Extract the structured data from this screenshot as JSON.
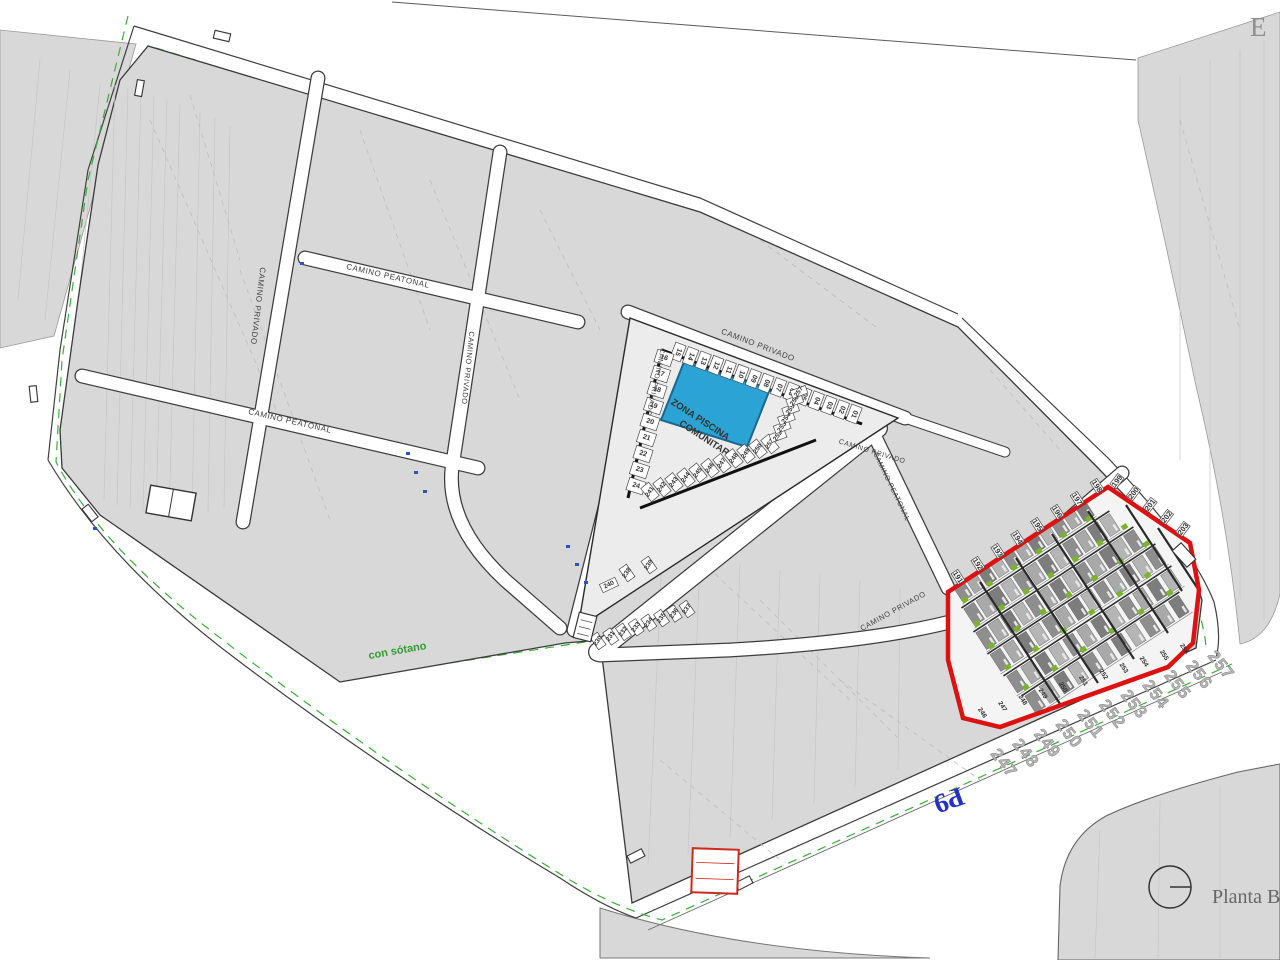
{
  "top_right_letter": "E",
  "planta_label": "Planta B",
  "p9_label": "P9",
  "con_sotano_label": "con sótano",
  "pool": {
    "line1": "ZONA PISCINA",
    "line2": "COMUNITARIA"
  },
  "colors": {
    "parcel": "#d8d8d8",
    "road_green": "#3cac3c",
    "red_border": "#dd1111",
    "pool_fill": "#2ba3d4",
    "pool_stroke": "#19688f",
    "blue_text": "#2430c8",
    "green_text": "#2f9e2f",
    "bush": "#79b42c"
  },
  "road_labels": [
    {
      "text": "CAMINO PEATONAL",
      "x": 388,
      "y": 276,
      "rot": 13,
      "size": 8
    },
    {
      "text": "CAMINO PRIVADO",
      "x": 258,
      "y": 306,
      "rot": 97,
      "size": 8
    },
    {
      "text": "CAMINO PEATONAL",
      "x": 290,
      "y": 421,
      "rot": 13,
      "size": 8
    },
    {
      "text": "CAMINO PRIVADO",
      "x": 468,
      "y": 368,
      "rot": 96,
      "size": 7.5
    },
    {
      "text": "CAMINO PRIVADO",
      "x": 758,
      "y": 345,
      "rot": 21,
      "size": 8
    },
    {
      "text": "CAMINO PRIVADO",
      "x": 655,
      "y": 382,
      "rot": 102,
      "size": 7
    },
    {
      "text": "CAMINO PEATONAL",
      "x": 891,
      "y": 487,
      "rot": 64,
      "size": 7
    },
    {
      "text": "CAMINO PRIVADO",
      "x": 872,
      "y": 452,
      "rot": 17,
      "size": 7
    },
    {
      "text": "CAMINO PRIVADO",
      "x": 893,
      "y": 611,
      "rot": -29,
      "size": 7.5
    }
  ],
  "number_strips": [
    {
      "id": "pool-top",
      "values": [
        "15",
        "14",
        "13",
        "12",
        "11",
        "10",
        "09",
        "08",
        "07",
        "06",
        "05",
        "04",
        "03",
        "02",
        "01"
      ],
      "x1": 678,
      "y1": 352,
      "x2": 854,
      "y2": 414,
      "rot": 111,
      "size": 7,
      "cell": {
        "w": 11,
        "h": 17,
        "rot": 21
      }
    },
    {
      "id": "pool-left",
      "values": [
        "16",
        "17",
        "18",
        "19",
        "20",
        "21",
        "22",
        "23",
        "24"
      ],
      "x1": 664,
      "y1": 358,
      "x2": 636,
      "y2": 486,
      "rot": 18,
      "size": 7,
      "cell": {
        "w": 17,
        "h": 13,
        "rot": 18
      }
    },
    {
      "id": "row-241",
      "values": [
        "241",
        "242",
        "243",
        "244",
        "245",
        "246",
        "247",
        "248",
        "249",
        "250",
        "251"
      ],
      "x1": 650,
      "y1": 492,
      "x2": 770,
      "y2": 444,
      "rot": -55,
      "size": 6.5,
      "cell": {
        "w": 10,
        "h": 17,
        "rot": -39
      }
    },
    {
      "id": "row-252",
      "values": [
        "252",
        "253",
        "254",
        "255",
        "256",
        "257"
      ],
      "x1": 778,
      "y1": 436,
      "x2": 799,
      "y2": 392,
      "rot": -55,
      "size": 6.5,
      "cell": {
        "w": 16,
        "h": 8,
        "rot": -20
      }
    },
    {
      "id": "tip-230",
      "values": [
        "230",
        "231",
        "232",
        "233",
        "234",
        "235",
        "236",
        "237"
      ],
      "x1": 598,
      "y1": 641,
      "x2": 687,
      "y2": 609,
      "rot": -55,
      "size": 6.5,
      "cell": {
        "w": 9,
        "h": 15,
        "rot": -35
      }
    },
    {
      "id": "tip-238",
      "values": [
        "238",
        "239"
      ],
      "x1": 627,
      "y1": 573,
      "x2": 649,
      "y2": 565,
      "rot": -55,
      "size": 6.5,
      "cell": {
        "w": 9,
        "h": 15,
        "rot": -35
      }
    },
    {
      "id": "tip-240",
      "values": [
        "240"
      ],
      "x1": 609,
      "y1": 585,
      "x2": 609,
      "y2": 585,
      "rot": -25,
      "size": 6.5,
      "cell": {
        "w": 17,
        "h": 9,
        "rot": -25
      }
    },
    {
      "id": "red-top",
      "values": [
        "191",
        "192",
        "193",
        "194",
        "195",
        "196",
        "197",
        "198"
      ],
      "x1": 958,
      "y1": 577,
      "x2": 1097,
      "y2": 486,
      "rot": 57,
      "size": 7.5,
      "cell": {
        "w": 8,
        "h": 13,
        "rot": -33
      }
    },
    {
      "id": "red-corner",
      "values": [
        "199",
        "200",
        "201",
        "202",
        "203"
      ],
      "x1": 1117,
      "y1": 481,
      "x2": 1183,
      "y2": 529,
      "rot": -53,
      "size": 7.5,
      "cell": {
        "w": 8,
        "h": 13,
        "rot": 37
      }
    },
    {
      "id": "red-bottom-small",
      "values": [
        "246",
        "247",
        "248",
        "249",
        "250",
        "251",
        "252",
        "253",
        "254",
        "255",
        "256"
      ],
      "x1": 982,
      "y1": 713,
      "x2": 1184,
      "y2": 649,
      "rot": 57,
      "size": 6.5
    },
    {
      "id": "street-numbers",
      "values": [
        "247",
        "248",
        "249",
        "250",
        "251",
        "252",
        "253",
        "254",
        "255",
        "256",
        "257"
      ],
      "x1": 1004,
      "y1": 763,
      "x2": 1221,
      "y2": 665,
      "rot": 52,
      "size": 17,
      "cls": "bignum"
    }
  ],
  "red_zone": {
    "rows": [
      {
        "x1": 956,
        "y1": 594,
        "x2": 1090,
        "y2": 506,
        "n": 11
      },
      {
        "x1": 968,
        "y1": 618,
        "x2": 1116,
        "y2": 521,
        "n": 12
      },
      {
        "x1": 980,
        "y1": 642,
        "x2": 1140,
        "y2": 537,
        "n": 13
      },
      {
        "x1": 994,
        "y1": 664,
        "x2": 1162,
        "y2": 554,
        "n": 13
      },
      {
        "x1": 1010,
        "y1": 686,
        "x2": 1178,
        "y2": 576,
        "n": 12
      },
      {
        "x1": 1028,
        "y1": 706,
        "x2": 1186,
        "y2": 602,
        "n": 11
      }
    ]
  }
}
